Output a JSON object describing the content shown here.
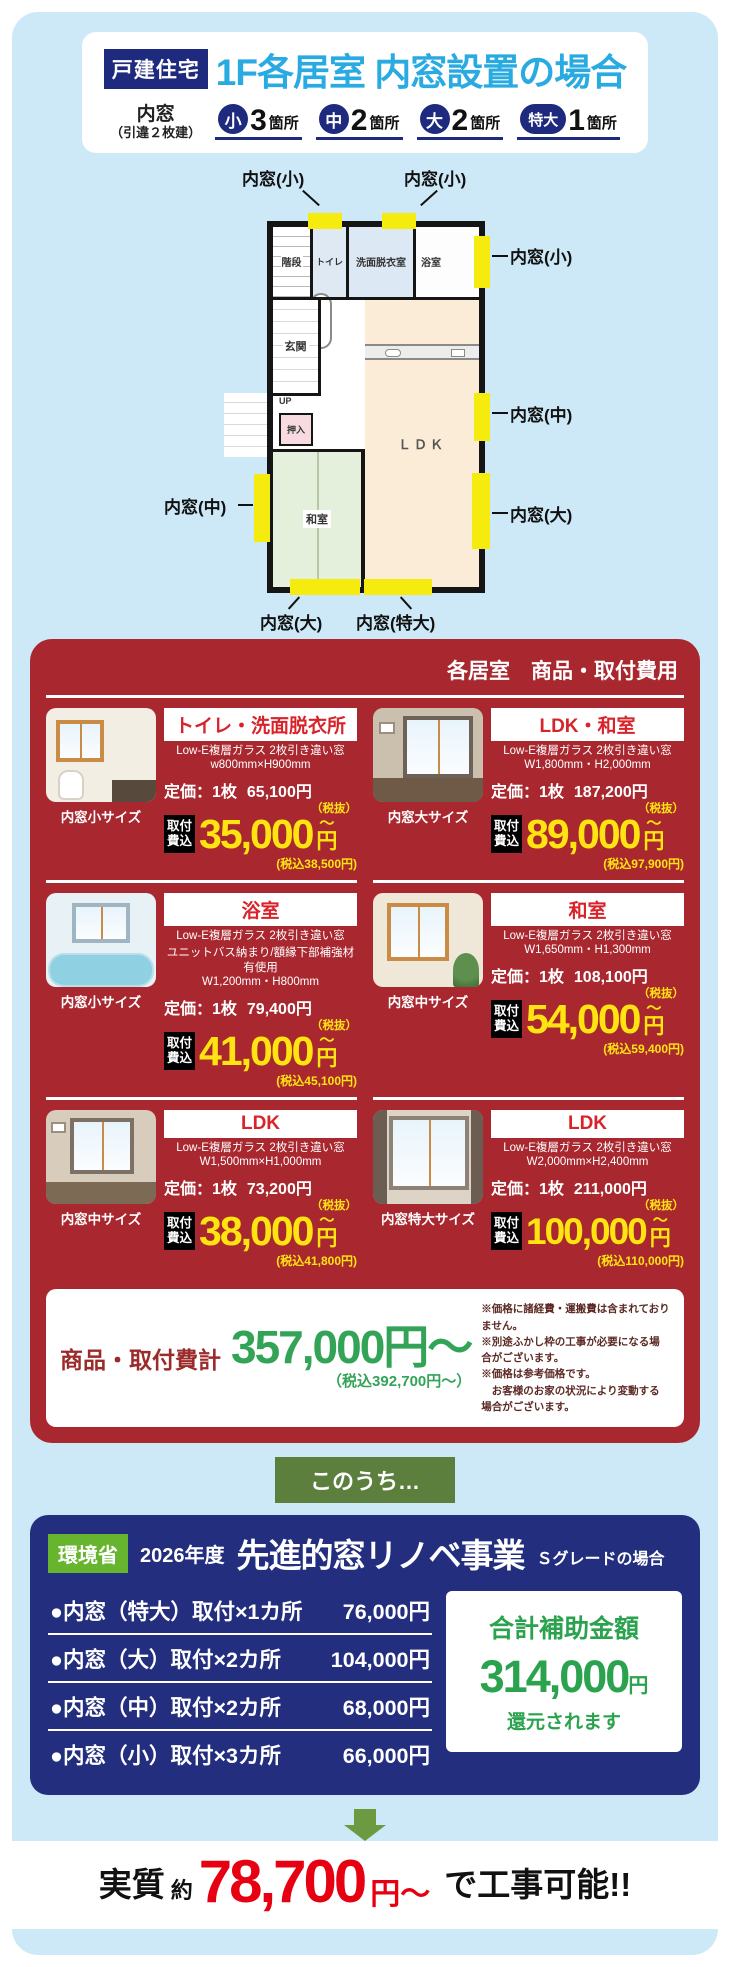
{
  "header": {
    "badge": "戸建住宅",
    "title": "1F各居室 内窓設置の場合",
    "subtitle_line1": "内窓",
    "subtitle_line2": "（引違２枚建）",
    "counts": [
      {
        "size": "小",
        "num": "3",
        "unit": "箇所"
      },
      {
        "size": "中",
        "num": "2",
        "unit": "箇所"
      },
      {
        "size": "大",
        "num": "2",
        "unit": "箇所"
      },
      {
        "size": "特大",
        "num": "1",
        "unit": "箇所"
      }
    ]
  },
  "floorplan": {
    "rooms": {
      "stairs": "階段",
      "up": "UP",
      "toilet": "トイレ",
      "washroom": "洗面脱衣室",
      "bathroom": "浴室",
      "entrance": "玄関",
      "closet": "押入",
      "japanese_room": "和室",
      "ldk": "ＬＤＫ"
    },
    "labels": {
      "top_left": "内窓(小)",
      "top_center": "内窓(小)",
      "right_top": "内窓(小)",
      "right_middle": "内窓(中)",
      "right_bottom": "内窓(大)",
      "left": "内窓(中)",
      "bottom_left": "内窓(大)",
      "bottom_right": "内窓(特大)"
    }
  },
  "pricing": {
    "panel_title": "各居室　商品・取付費用",
    "list_label": "定価：1枚",
    "tax_note": "（税抜）",
    "chip_line1": "取付",
    "chip_line2": "費込",
    "cards": [
      {
        "room": "トイレ・洗面脱衣所",
        "spec1": "Low-E複層ガラス 2枚引き違い窓",
        "spec_extra": "",
        "spec2": "w800mm×H900mm",
        "list_price": "65,100円",
        "price": "35,000",
        "tilde": "〜",
        "yen": "円",
        "tax_incl": "(税込38,500円)",
        "caption": "内窓小サイズ"
      },
      {
        "room": "LDK・和室",
        "spec1": "Low-E複層ガラス 2枚引き違い窓",
        "spec_extra": "",
        "spec2": "W1,800mm・H2,000mm",
        "list_price": "187,200円",
        "price": "89,000",
        "tilde": "〜",
        "yen": "円",
        "tax_incl": "(税込97,900円)",
        "caption": "内窓大サイズ"
      },
      {
        "room": "浴室",
        "spec1": "Low-E複層ガラス 2枚引き違い窓",
        "spec_extra": "ユニットバス納まり/額縁下部補強材有使用",
        "spec2": "W1,200mm・H800mm",
        "list_price": "79,400円",
        "price": "41,000",
        "tilde": "〜",
        "yen": "円",
        "tax_incl": "(税込45,100円)",
        "caption": "内窓小サイズ"
      },
      {
        "room": "和室",
        "spec1": "Low-E複層ガラス 2枚引き違い窓",
        "spec_extra": "",
        "spec2": "W1,650mm・H1,300mm",
        "list_price": "108,100円",
        "price": "54,000",
        "tilde": "〜",
        "yen": "円",
        "tax_incl": "(税込59,400円)",
        "caption": "内窓中サイズ"
      },
      {
        "room": "LDK",
        "spec1": "Low-E複層ガラス 2枚引き違い窓",
        "spec_extra": "",
        "spec2": "W1,500mm×H1,000mm",
        "list_price": "73,200円",
        "price": "38,000",
        "tilde": "〜",
        "yen": "円",
        "tax_incl": "(税込41,800円)",
        "caption": "内窓中サイズ"
      },
      {
        "room": "LDK",
        "spec1": "Low-E複層ガラス 2枚引き違い窓",
        "spec_extra": "",
        "spec2": "W2,000mm×H2,400mm",
        "list_price": "211,000円",
        "price": "100,000",
        "tilde": "〜",
        "yen": "円",
        "tax_incl": "(税込110,000円)",
        "caption": "内窓特大サイズ"
      }
    ],
    "total": {
      "label": "商品・取付費計",
      "price": "357,000円〜",
      "tax_incl": "（税込392,700円〜）",
      "notes": [
        "※価格に諸経費・運搬費は含まれておりません。",
        "※別途ふかし枠の工事が必要になる場合がございます。",
        "※価格は参考価格です。",
        "　お客様のお家の状況により変動する場合がございます。"
      ]
    }
  },
  "connector_label": "このうち…",
  "subsidy": {
    "badge": "環境省",
    "year": "2026年度",
    "title": "先進的窓リノベ事業",
    "grade": "Ｓグレードの場合",
    "items": [
      {
        "text": "●内窓（特大）取付×1カ所",
        "price": "76,000円"
      },
      {
        "text": "●内窓（大）取付×2カ所",
        "price": "104,000円"
      },
      {
        "text": "●内窓（中）取付×2カ所",
        "price": "68,000円"
      },
      {
        "text": "●内窓（小）取付×3カ所",
        "price": "66,000円"
      }
    ],
    "grant": {
      "label": "合計補助金額",
      "amount": "314,000",
      "yen": "円",
      "suffix": "還元されます"
    }
  },
  "footer": {
    "prefix": "実質",
    "approx": "約",
    "price": "78,700",
    "yen": "円〜",
    "suffix": "で工事可能!!"
  }
}
